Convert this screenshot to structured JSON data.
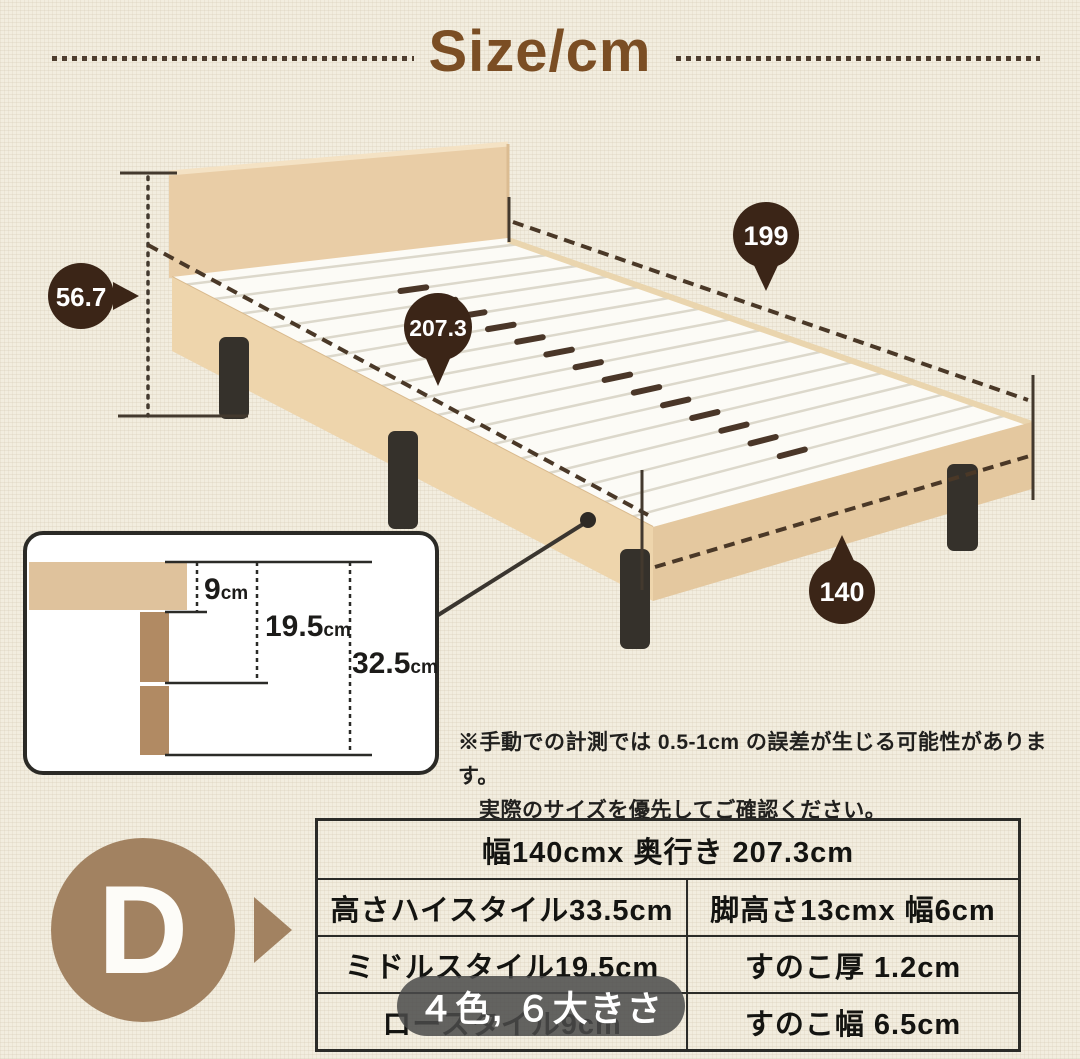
{
  "page": {
    "title": "Size/cm"
  },
  "bed_diagram": {
    "measurements": {
      "total_height": "56.7",
      "total_length": "207.3",
      "top_length": "199",
      "width": "140"
    }
  },
  "detail_inset": {
    "labels": [
      {
        "value": "9",
        "unit": "cm"
      },
      {
        "value": "19.5",
        "unit": "cm"
      },
      {
        "value": "32.5",
        "unit": "cm"
      }
    ]
  },
  "note": {
    "line1": "※手動での計測では 0.5-1cm の誤差が生じる可能性があります。",
    "line2": "実際のサイズを優先してご確認ください。"
  },
  "spec_table": {
    "row1": "幅140cmx 奥行き 207.3cm",
    "row2_left": "高さハイスタイル33.5cm",
    "row2_right": "脚高さ13cmx  幅6cm",
    "row3_left": "ミドルスタイル19.5cm",
    "row3_right": "すのこ厚 1.2cm",
    "row4_left": "ロースタイル9cm",
    "row4_right": "すのこ幅 6.5cm"
  },
  "variant_badge": {
    "label": "D"
  },
  "overlay": {
    "caption": "４色, ６大きさ"
  },
  "colors": {
    "background": "#f2eddf",
    "title_brown": "#7b4e24",
    "badge_dark_brown": "#3b2517",
    "wood_tan": "#e9cda6",
    "wood_tan_front": "#eed5ac",
    "leg_dark": "#35312b",
    "d_badge_brown": "#a28261",
    "table_border": "#2b2b28",
    "overlay_gray": "rgba(74,74,74,0.85)"
  }
}
